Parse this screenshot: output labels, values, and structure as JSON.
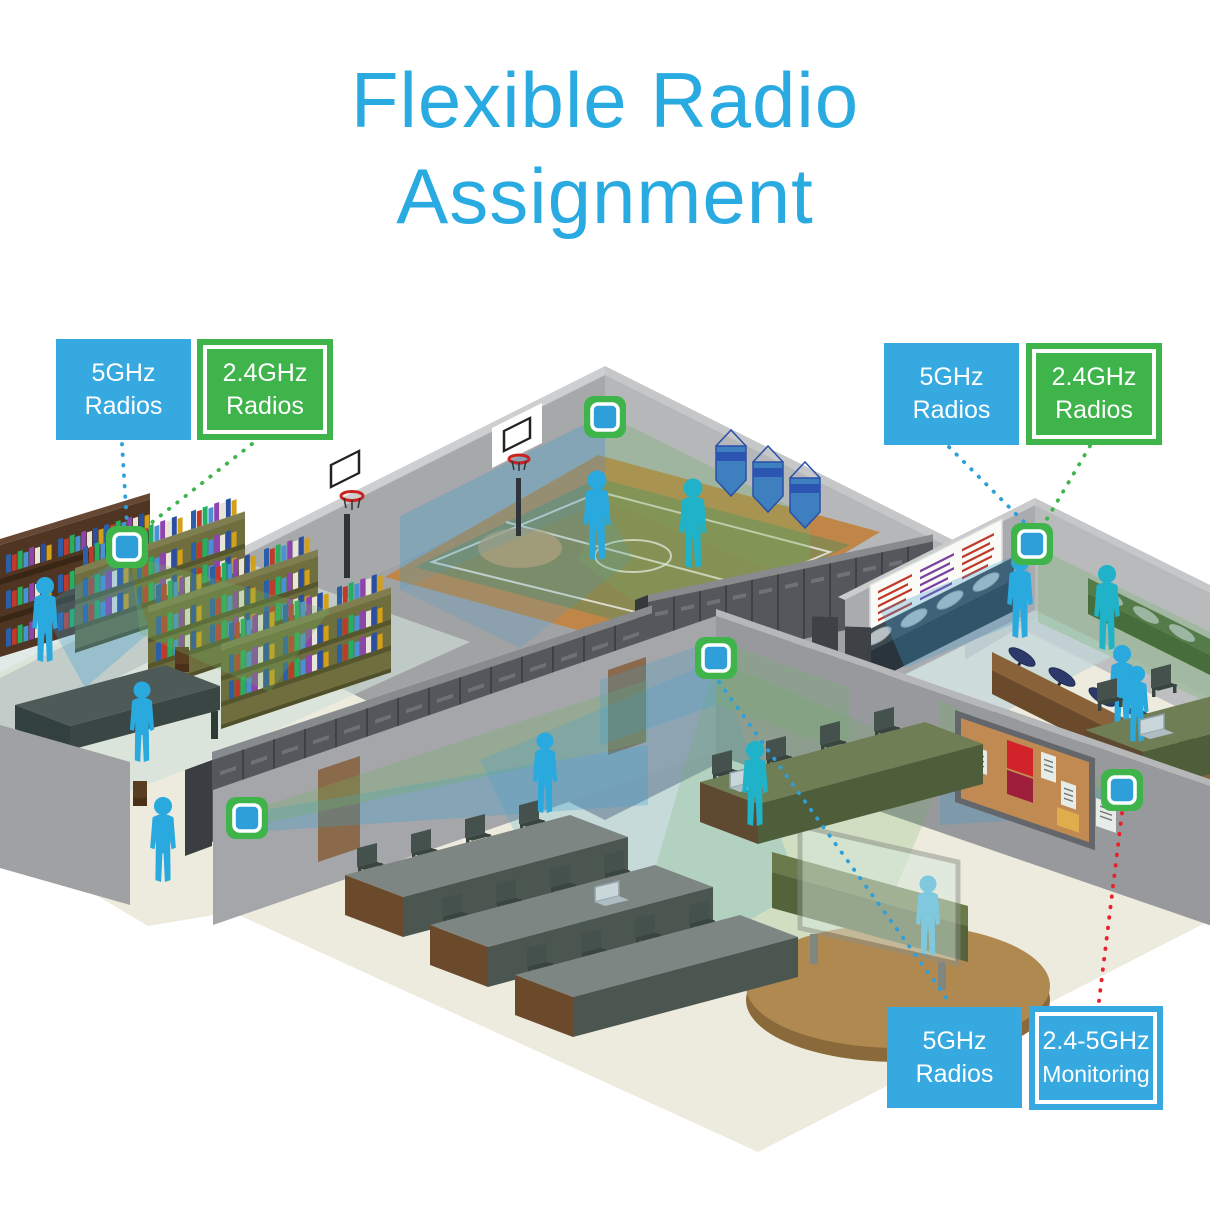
{
  "title": {
    "line1": "Flexible Radio",
    "line2": "Assignment"
  },
  "labels": [
    {
      "id": "top-left-5ghz",
      "line1": "5GHz",
      "line2": "Radios",
      "variant": "blue"
    },
    {
      "id": "top-left-2-4ghz",
      "line1": "2.4GHz",
      "line2": "Radios",
      "variant": "green-outline"
    },
    {
      "id": "top-right-5ghz",
      "line1": "5GHz",
      "line2": "Radios",
      "variant": "blue"
    },
    {
      "id": "top-right-2-4ghz",
      "line1": "2.4GHz",
      "line2": "Radios",
      "variant": "green-outline"
    },
    {
      "id": "bottom-5ghz",
      "line1": "5GHz",
      "line2": "Radios",
      "variant": "blue"
    },
    {
      "id": "bottom-monitoring",
      "line1": "2.4-5GHz",
      "line2": "Monitoring",
      "variant": "blue-outline"
    }
  ],
  "access_points": [
    {
      "id": "gym-ap"
    },
    {
      "id": "library-ap"
    },
    {
      "id": "cafeteria-ap"
    },
    {
      "id": "classroom-ap"
    },
    {
      "id": "hallway-ap"
    },
    {
      "id": "monitoring-ap"
    }
  ],
  "connectors": [
    {
      "from": "top-left-5ghz",
      "to": "library-ap",
      "color": "#2E9FD8",
      "style": "dotted"
    },
    {
      "from": "top-left-2-4ghz",
      "to": "library-ap",
      "color": "#3EB44A",
      "style": "dotted"
    },
    {
      "from": "top-right-5ghz",
      "to": "cafeteria-ap",
      "color": "#2E9FD8",
      "style": "dotted"
    },
    {
      "from": "top-right-2-4ghz",
      "to": "cafeteria-ap",
      "color": "#3EB44A",
      "style": "dotted"
    },
    {
      "from": "classroom-ap",
      "to": "bottom-5ghz",
      "color": "#2E9FD8",
      "style": "dotted"
    },
    {
      "from": "monitoring-ap",
      "to": "bottom-monitoring",
      "color": "#E8212D",
      "style": "dotted"
    }
  ],
  "colors": {
    "title": "#29ABE2",
    "label_blue": "#36A9E1",
    "label_green": "#3EB44A",
    "monitor_line_red": "#E8212D",
    "ap_green": "#3EB44A",
    "ap_blue": "#2E9FD8",
    "beam_5ghz_blue": "#3E9FD0",
    "beam_24ghz_green": "#6FB362",
    "person_blue": "#29A9DE"
  }
}
